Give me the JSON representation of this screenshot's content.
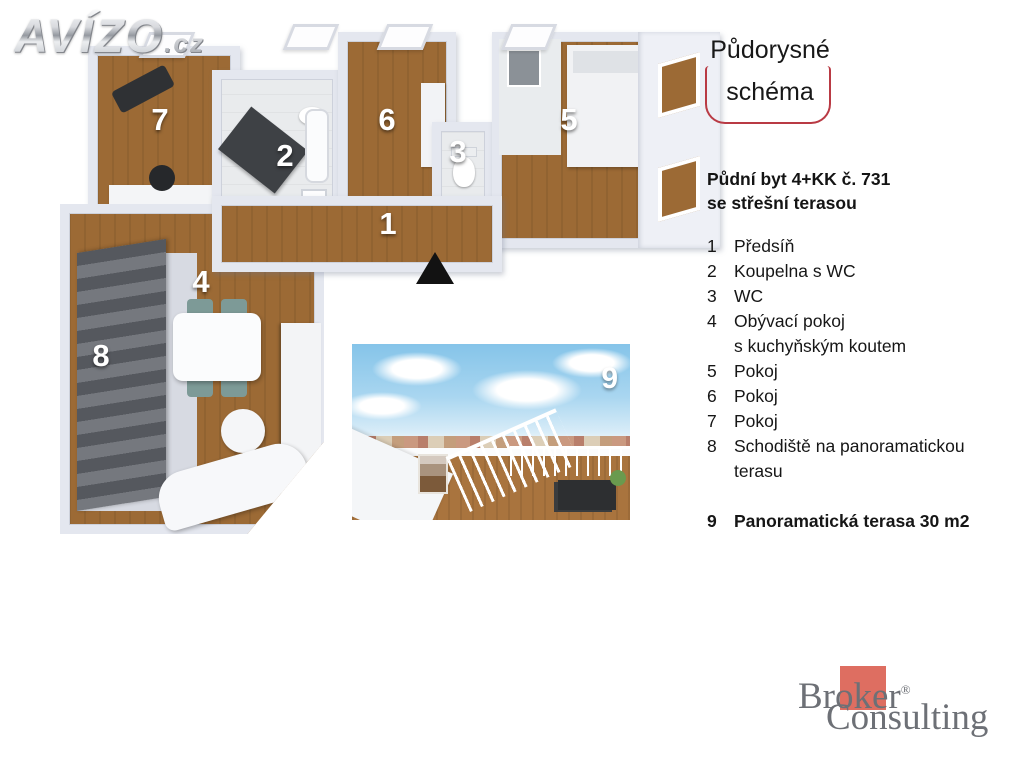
{
  "logo": {
    "name": "AVÍZO",
    "tld": ".cz"
  },
  "title_box": {
    "line1": "Půdorysné",
    "line2": "schéma"
  },
  "listing": {
    "title_line1": "Půdní byt 4+KK č. 731",
    "title_line2": "se střešní terasou"
  },
  "legend": {
    "items": [
      {
        "num": "1",
        "label": "Předsíň"
      },
      {
        "num": "2",
        "label": "Koupelna s WC"
      },
      {
        "num": "3",
        "label": "WC"
      },
      {
        "num": "4",
        "label": "Obývací pokoj",
        "label2": "s kuchyňským koutem"
      },
      {
        "num": "5",
        "label": "Pokoj"
      },
      {
        "num": "6",
        "label": "Pokoj"
      },
      {
        "num": "7",
        "label": "Pokoj"
      },
      {
        "num": "8",
        "label": "Schodiště na panoramatickou",
        "label2": "terasu"
      },
      {
        "num": "9",
        "label": "Panoramatická terasa 30 m2"
      }
    ]
  },
  "floorplan": {
    "rooms": [
      {
        "num": "1"
      },
      {
        "num": "2"
      },
      {
        "num": "3"
      },
      {
        "num": "4"
      },
      {
        "num": "5"
      },
      {
        "num": "6"
      },
      {
        "num": "7"
      },
      {
        "num": "8"
      }
    ],
    "photo_number": "9"
  },
  "brand": {
    "line1": "Broker",
    "reg": "®",
    "line2": "Consulting"
  },
  "colors": {
    "accent_red": "#b93a44",
    "brand_red": "#de6e61",
    "wood": "#9c6a35",
    "wall": "#e4e7ef"
  }
}
